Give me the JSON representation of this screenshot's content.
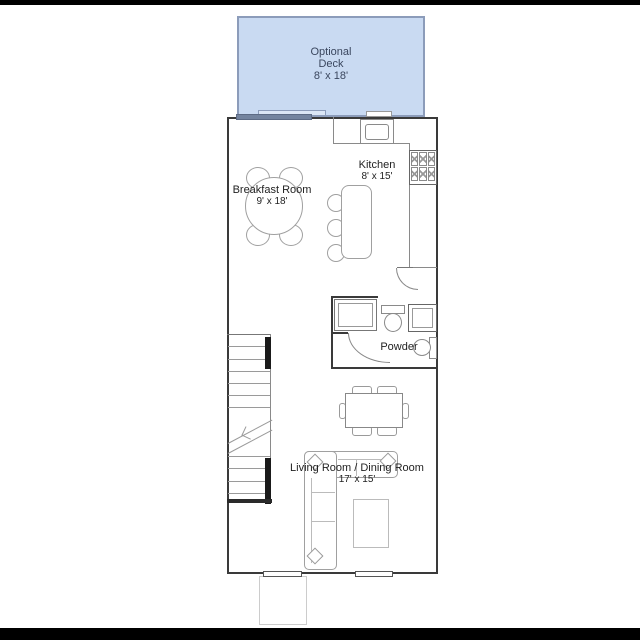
{
  "deck": {
    "line1": "Optional",
    "line2": "Deck",
    "dims": "8' x 18'"
  },
  "kitchen": {
    "name": "Kitchen",
    "dims": "8' x 15'"
  },
  "breakfast": {
    "name": "Breakfast Room",
    "dims": "9' x 18'"
  },
  "powder": {
    "name": "Powder"
  },
  "living": {
    "name": "Living Room / Dining Room",
    "dims": "17' x 15'"
  },
  "colors": {
    "deck_fill": "#c9daf2",
    "deck_border": "#8c9cba",
    "deck_text": "#3a465e",
    "wall": "#3a3a3a",
    "furniture_line": "#a0a0a0",
    "label_text": "#1f1f1f",
    "letterbox": "#000000",
    "sliding_door_dark": "#74849f"
  },
  "fixtures": {
    "stove": "stove-icon",
    "kitchen_sink": "kitchen-sink-icon",
    "island_stools": "stool-icon",
    "toilet": "toilet-icon",
    "powder_sink": "pedestal-sink-icon",
    "stairs": "stairs",
    "sliding_door": "sliding-door",
    "windows": "window-symbol"
  }
}
